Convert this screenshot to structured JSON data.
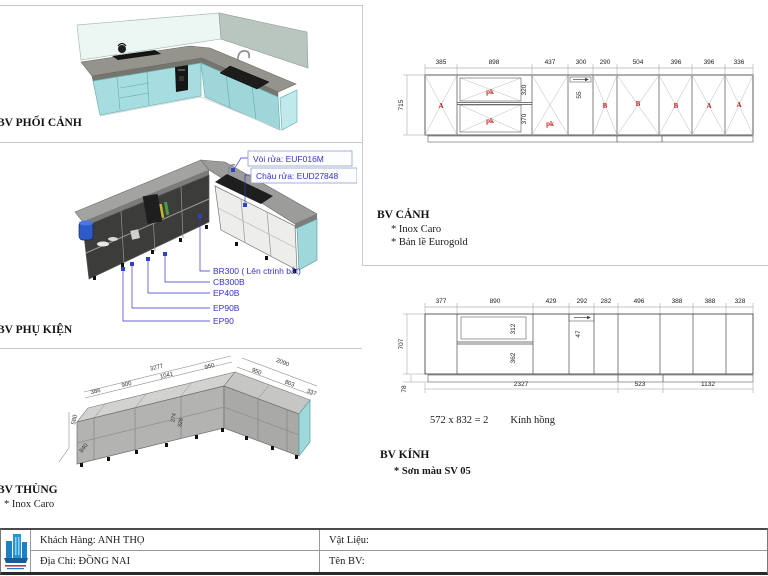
{
  "colors": {
    "annotation_blue": "#3434cc",
    "letter_red": "#c32222",
    "cabinet_teal": "#a6dde0",
    "counter_gray": "#94948c",
    "logo_blue": "#1d7fc4"
  },
  "phoi_canh": {
    "label": "BV PHỐI CẢNH"
  },
  "phu_kien": {
    "label": "BV PHỤ KIỆN",
    "faucet_label": "Vòi rửa: EUF016M",
    "sink_label": "Chậu rửa: EUD27848",
    "parts": [
      "BR300 ( Lên ctrinh bắt)",
      "CB300B",
      "EP40B",
      "EP90B",
      "EP90"
    ]
  },
  "thung": {
    "label": "BV THÙNG",
    "note": "* Inox Caro",
    "total": "3277",
    "segs": [
      "386",
      "900",
      "1041",
      "950"
    ],
    "right_total": "2090",
    "right_segs": [
      "950",
      "803",
      "337"
    ],
    "height": "580",
    "depth": "840",
    "inner": [
      "274",
      "328"
    ]
  },
  "canh": {
    "label": "BV CẢNH",
    "note1": "* Inox Caro",
    "note2": "* Bản lề Eurogold",
    "top_dims": [
      "385",
      "898",
      "437",
      "300",
      "290",
      "504",
      "396",
      "396",
      "336"
    ],
    "height": "715",
    "d320": "320",
    "d370": "370",
    "d55": "55",
    "letters": [
      "A",
      "pk",
      "pk",
      "pk",
      "B",
      "B",
      "B",
      "A",
      "A"
    ]
  },
  "kinh": {
    "label": "BV KÍNH",
    "note": "* Sơn màu SV 05",
    "glass_calc": "572 x 832 = 2",
    "glass_name": "Kính hồng",
    "top_dims": [
      "377",
      "890",
      "429",
      "292",
      "282",
      "496",
      "388",
      "388",
      "328"
    ],
    "height": "707",
    "plinth": "78",
    "d312": "312",
    "d362": "362",
    "d47": "47",
    "bottom_dims": [
      "2327",
      "523",
      "1132"
    ]
  },
  "title_block": {
    "customer": "Khách Hàng: ANH THỌ",
    "address": "Địa Chỉ: ĐỒNG NAI",
    "material_label": "Vật Liệu:",
    "name_label": "Tên BV:"
  }
}
